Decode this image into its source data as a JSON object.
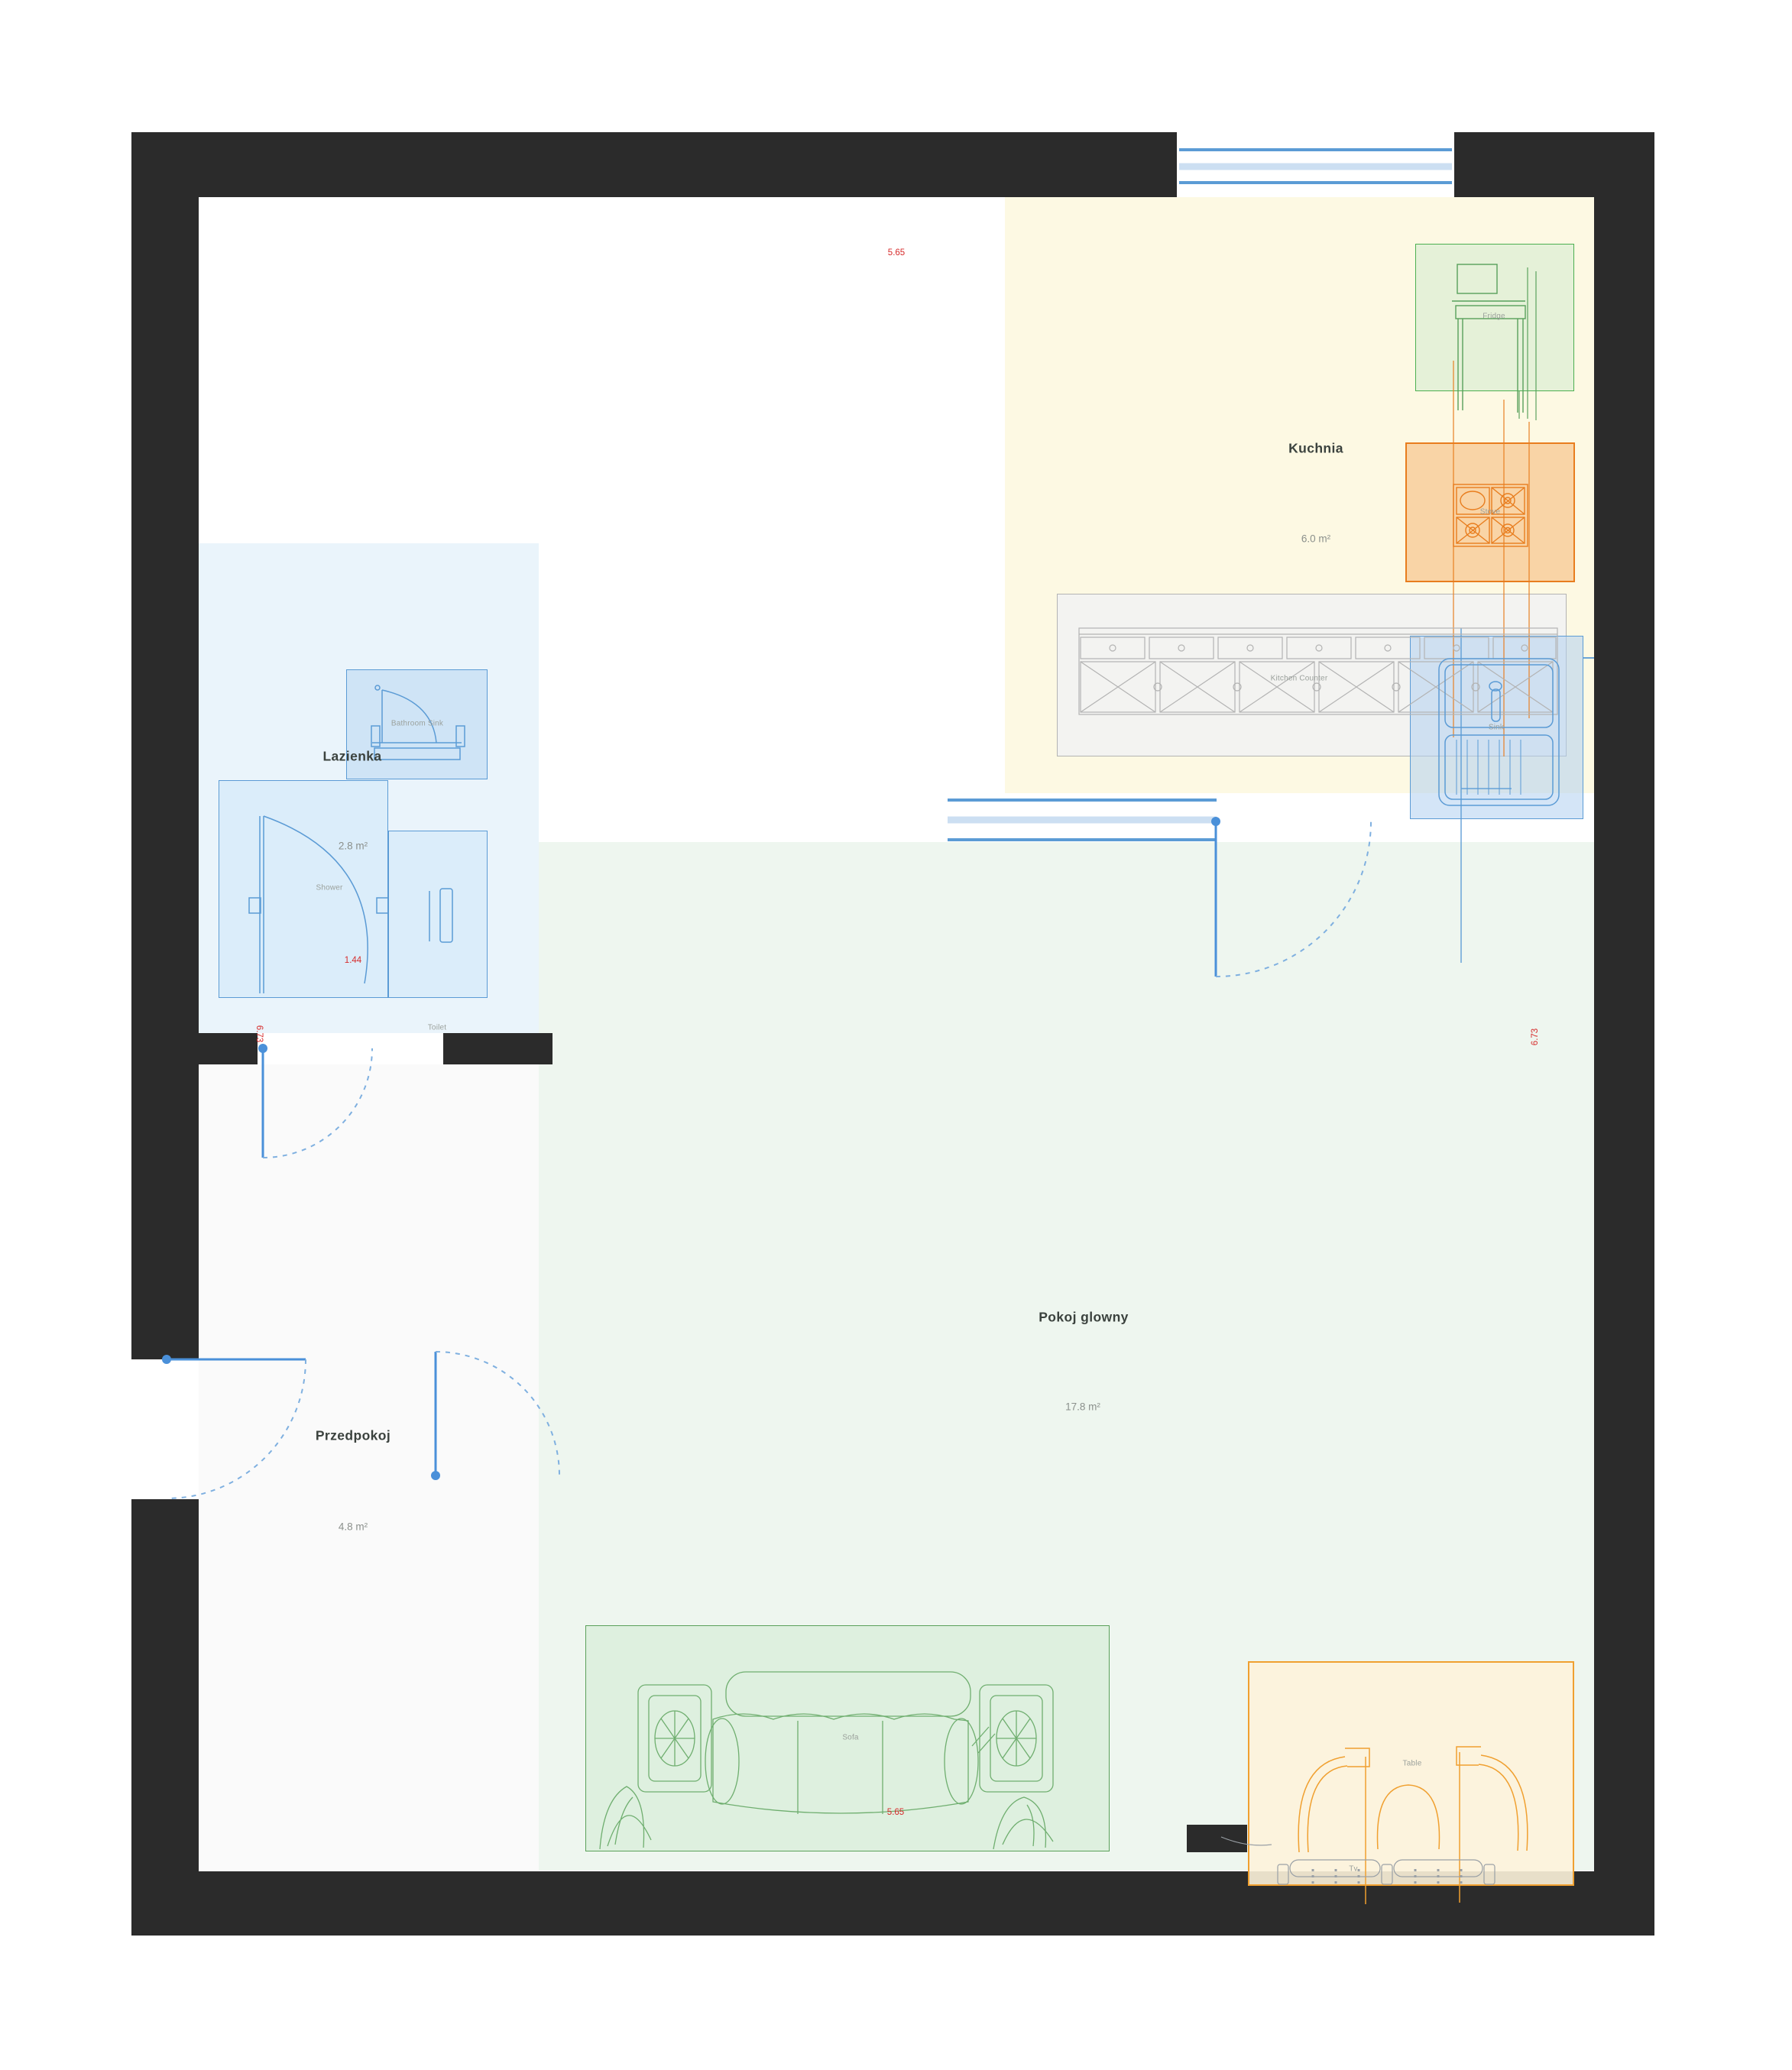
{
  "plan": {
    "rooms": {
      "kitchen": {
        "name": "Kuchnia",
        "area": "6.0 m²"
      },
      "bathroom": {
        "name": "Lazienka",
        "area": "2.8 m²"
      },
      "hallway": {
        "name": "Przedpokoj",
        "area": "4.8 m²"
      },
      "living": {
        "name": "Pokoj glowny",
        "area": "17.8 m²"
      }
    },
    "furniture": {
      "fridge": "Fridge",
      "stove": "Stove",
      "counter": "Kitchen Counter",
      "sink": "Sink",
      "bathroom_sink": "Bathroom Sink",
      "shower": "Shower",
      "toilet": "Toilet",
      "sofa": "Sofa",
      "table": "Table",
      "tv": "Tv"
    },
    "dimensions": {
      "top_width": "5.65",
      "bottom_width": "5.65",
      "bathroom_width": "1.44",
      "left_height": "6.73",
      "right_height": "6.73"
    },
    "colors": {
      "wall": "#2b2b2b",
      "kitchen_bg": "#fdf9e3",
      "bathroom_bg": "#eaf4fb",
      "hallway_bg": "#fafafa",
      "living_bg": "#eef6ef",
      "window_blue": "#5b9bd5",
      "window_light": "#ccdff2",
      "door_blue": "#4a90d9",
      "dimension_red": "#d62b2b",
      "fridge_green": "#4caf50",
      "stove_orange": "#e87d1e",
      "counter_gray": "#b3b3b3",
      "sofa_green": "#5aa05a",
      "table_orange": "#f0a030"
    }
  }
}
